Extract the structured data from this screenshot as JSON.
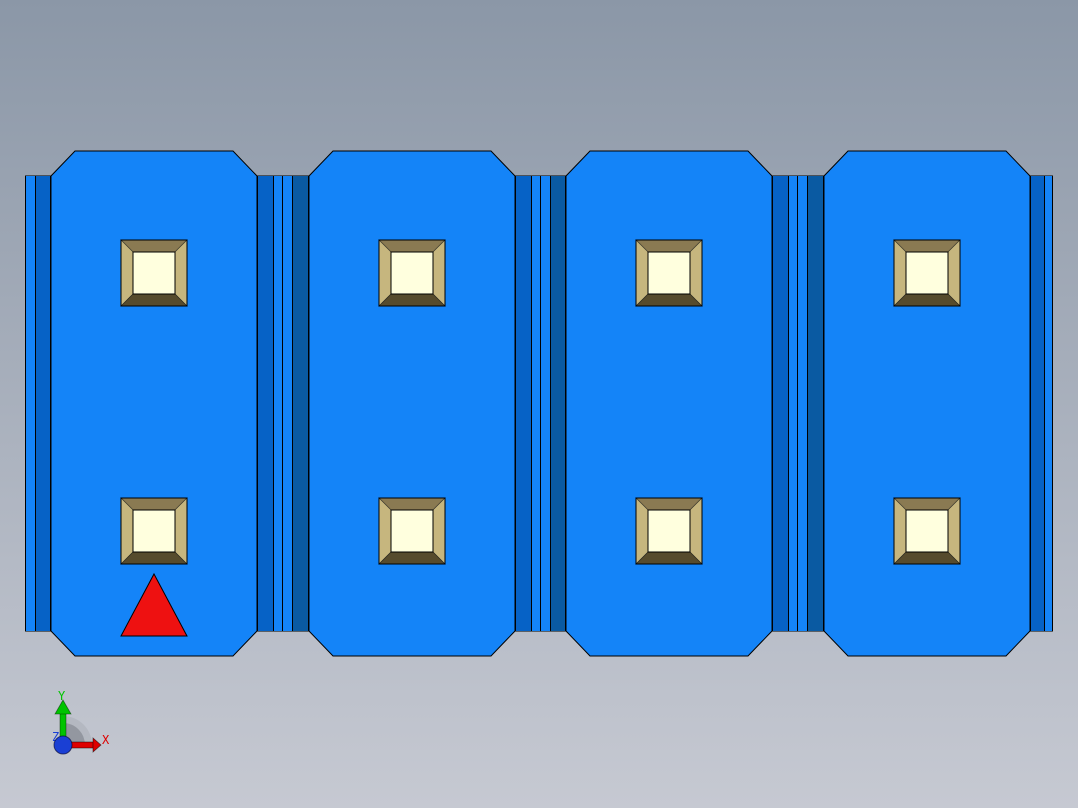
{
  "viewport": {
    "kind": "3d-model-view",
    "model": {
      "segment_count": 4,
      "sockets_per_segment": 2,
      "marker": "red-triangle-on-first-segment"
    }
  },
  "axis_triad": {
    "x_label": "X",
    "y_label": "Y",
    "z_label": "Z"
  },
  "colors": {
    "bg_top": "#8B97A7",
    "bg_bottom": "#C6C9D2",
    "body_blue": "#1484F8",
    "edge_line": "#000000",
    "groove_saturated": "#0662C6",
    "groove_shaded": "#0A5AA2",
    "socket_bevel_top": "#8A7A52",
    "socket_bevel_side": "#C6B67E",
    "socket_bevel_bottom": "#564B2D",
    "socket_inner": "#FFFFDE",
    "marker_red": "#EE1111",
    "axis_red": "#DE0000",
    "axis_green": "#00C400",
    "axis_blue": "#1A3FD4",
    "fan_light": "#B2B6BE",
    "fan_dark": "#8F949C"
  }
}
